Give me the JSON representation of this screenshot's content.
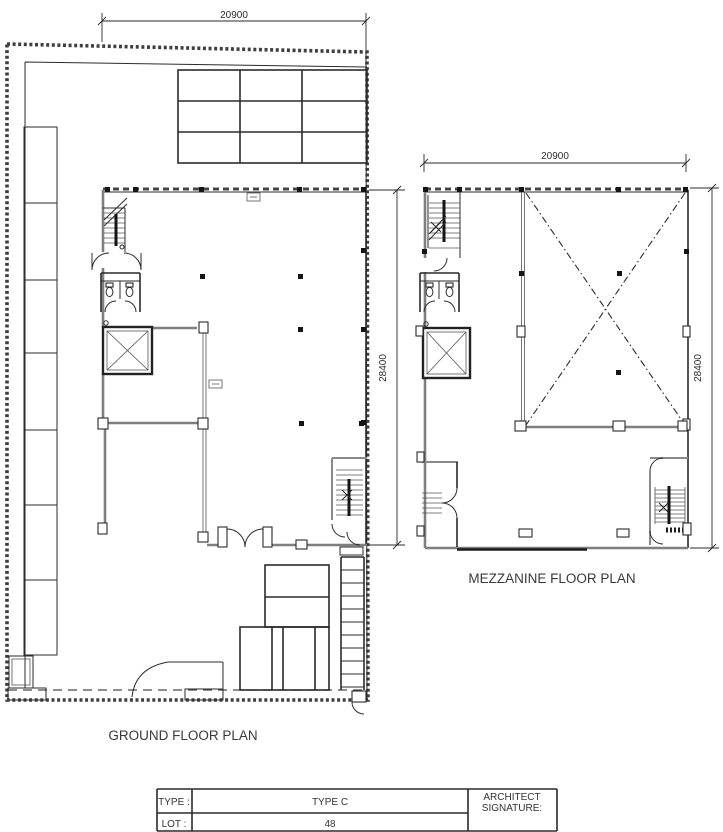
{
  "plans": {
    "ground": {
      "title": "GROUND FLOOR PLAN",
      "dim_top": "20900",
      "dim_side": "28400"
    },
    "mezzanine": {
      "title": "MEZZANINE FLOOR PLAN",
      "dim_top": "20900",
      "dim_side": "28400"
    }
  },
  "title_block": {
    "type_label": "TYPE :",
    "type_value": "TYPE C",
    "lot_label": "LOT :",
    "lot_value": "48",
    "architect_label_line1": "ARCHITECT",
    "architect_label_line2": "SIGNATURE:"
  }
}
